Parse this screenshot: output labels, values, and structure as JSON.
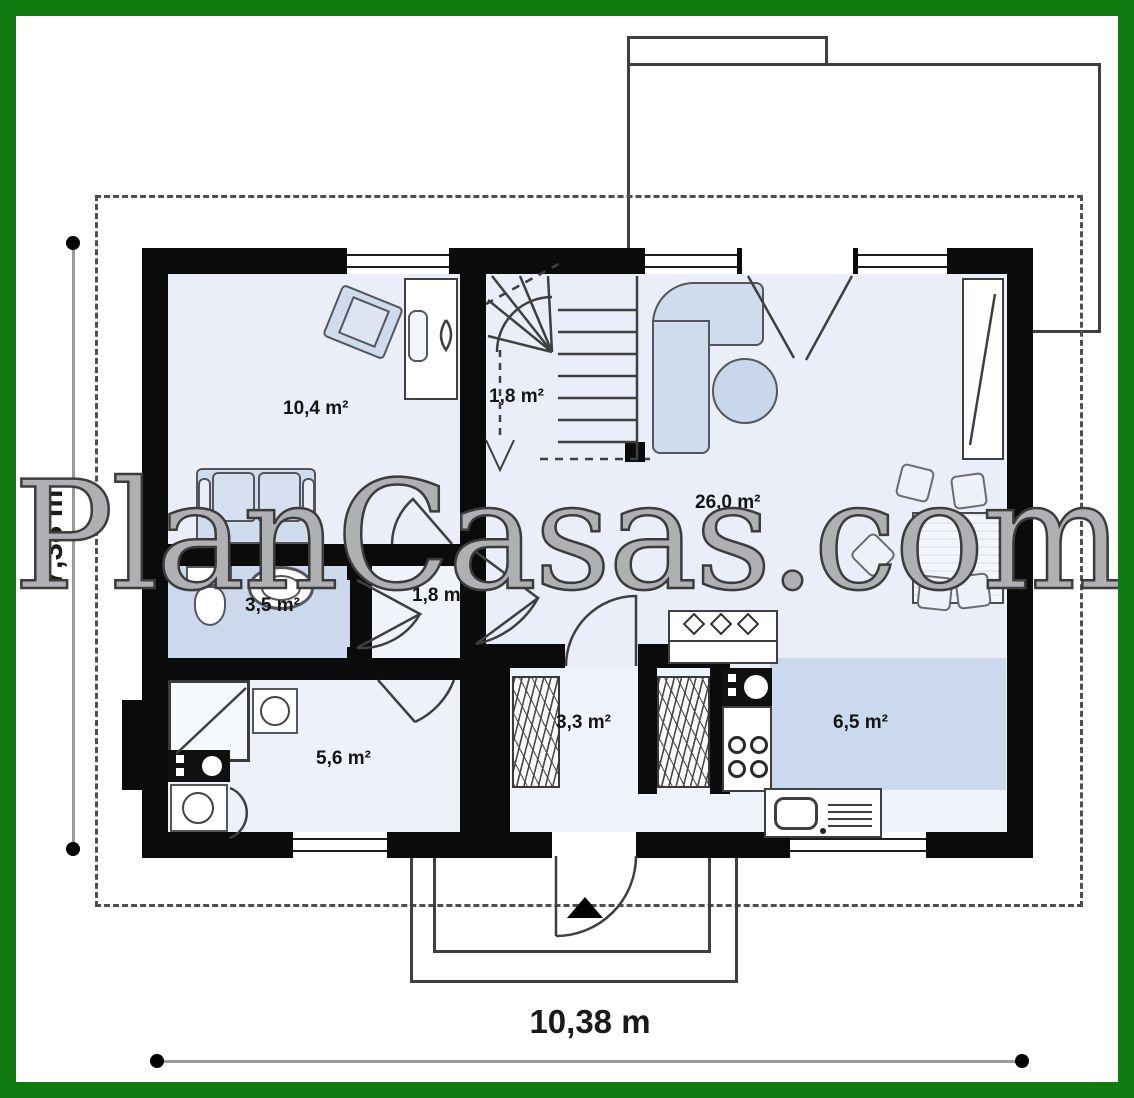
{
  "watermark": {
    "text": "PlanCasas.com"
  },
  "dimensions": {
    "height": "7,38 m",
    "width": "10,38 m"
  },
  "rooms": [
    {
      "name": "bedroom-office",
      "area": "10,4 m²"
    },
    {
      "name": "staircase",
      "area": "1,8 m²"
    },
    {
      "name": "living-dining",
      "area": "26,0 m²"
    },
    {
      "name": "bathroom",
      "area": "3,5 m²"
    },
    {
      "name": "hall",
      "area": "1,8 m²"
    },
    {
      "name": "utility-room",
      "area": "5,6 m²"
    },
    {
      "name": "entry-hall",
      "area": "3,3 m²"
    },
    {
      "name": "kitchen",
      "area": "6,5 m²"
    }
  ],
  "colors": {
    "frame_green": "#117b11",
    "wall_black": "#0b0b0b",
    "floor_light": "#e9eef8",
    "floor_blue": "#ccd9ec",
    "kitchen_patch_blue": "#cbd9ee",
    "line_gray": "#3f3f3f",
    "dim_gray": "#9a9a9a",
    "furniture_fill": "#cfdcee"
  }
}
